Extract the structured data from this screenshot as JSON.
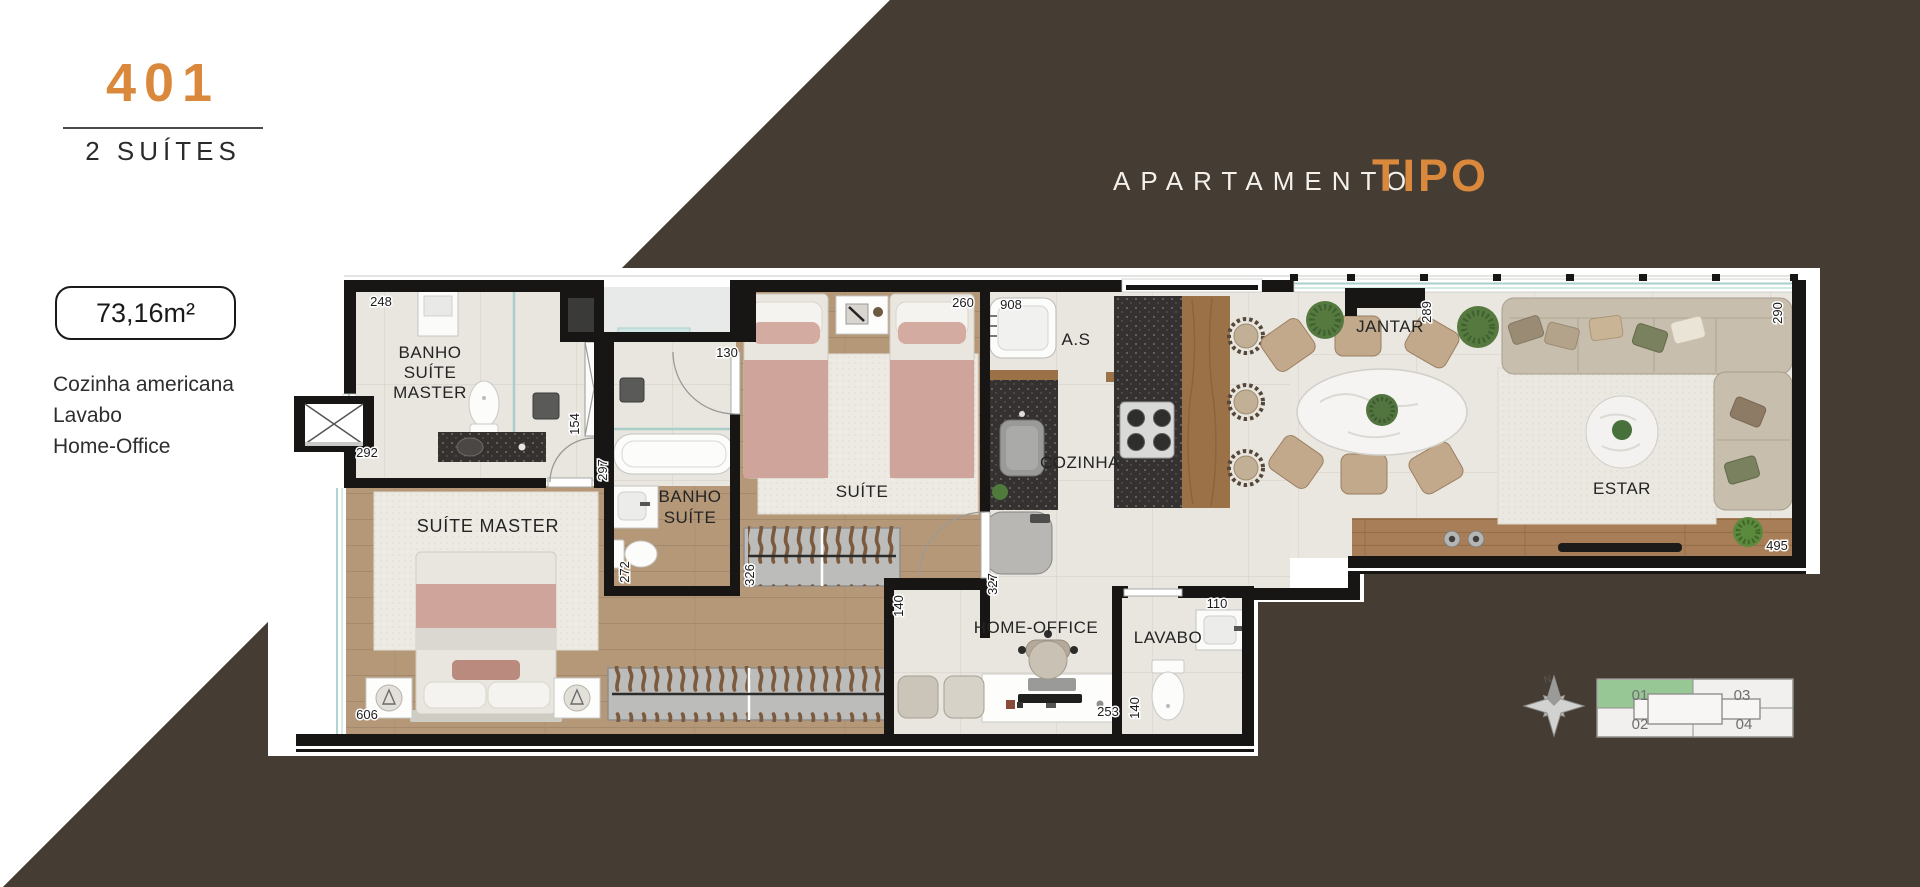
{
  "unit": {
    "number": "401",
    "type_label": "2 SUÍTES",
    "area": "73,16m²",
    "features": [
      "Cozinha americana",
      "Lavabo",
      "Home-Office"
    ]
  },
  "header": {
    "prefix": "APARTAMENTO",
    "highlight": "TIPO"
  },
  "plan": {
    "labels": {
      "banho_master": [
        "BANHO",
        "SUÍTE",
        "MASTER"
      ],
      "suite_master": "SUÍTE MASTER",
      "banho_suite": [
        "BANHO",
        "SUÍTE"
      ],
      "suite": "SUÍTE",
      "area_servico": "A.S",
      "cozinha": "COZINHA",
      "jantar": "JANTAR",
      "estar": "ESTAR",
      "home_office": "HOME-OFFICE",
      "lavabo": "LAVABO"
    },
    "dims": {
      "banho_master_width": "248",
      "entry_wall": "292",
      "shower_width": "154",
      "corridor_depth": "297",
      "banho_suite_recess": "130",
      "banho_suite_depth": "272",
      "suite_closet": "326",
      "suite_width": "260",
      "living_span": "908",
      "hall_depth": "327",
      "hall_width": "140",
      "home_office_width": "253",
      "lavabo_width": "140",
      "lavabo_door": "110",
      "jantar_wall": "289",
      "estar_depth": "290",
      "estar_width": "495",
      "suite_master_width": "606"
    }
  },
  "keyplan": {
    "north": "N",
    "units": [
      {
        "id": "01",
        "active": true
      },
      {
        "id": "02",
        "active": false
      },
      {
        "id": "03",
        "active": false
      },
      {
        "id": "04",
        "active": false
      }
    ]
  },
  "colors": {
    "accent_orange": "#d9883c",
    "background_band": "#453c33",
    "wall_black": "#181614",
    "keyplan_active": "#97c795",
    "window_glass": "#a9cfca"
  }
}
